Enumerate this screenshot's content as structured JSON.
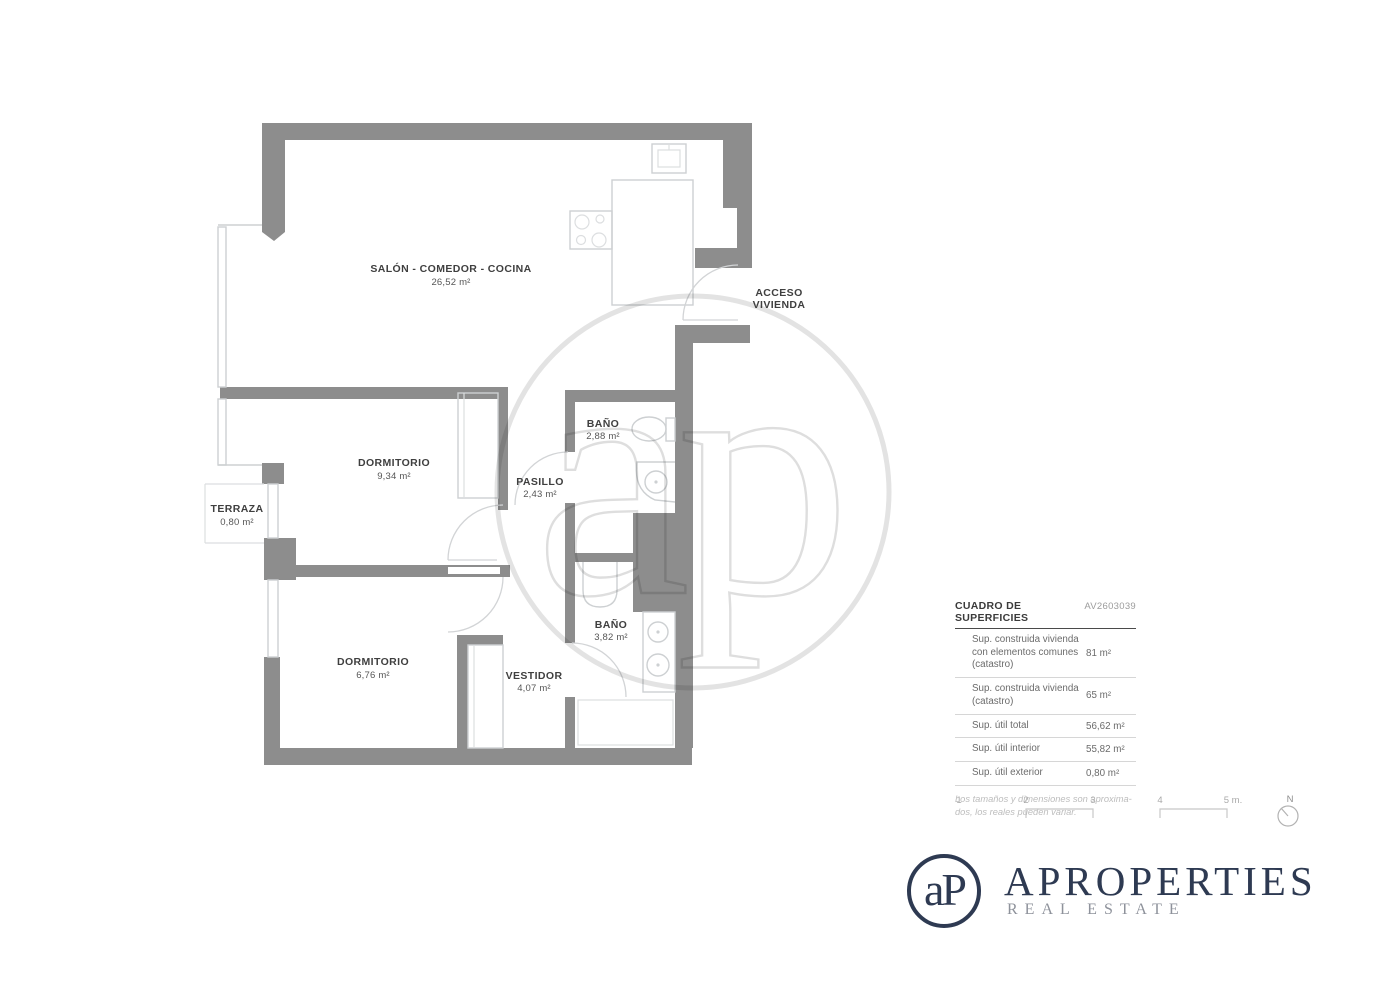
{
  "plan": {
    "rooms": [
      {
        "name": "SALÓN - COMEDOR - COCINA",
        "area": "26,52 m²"
      },
      {
        "name": "DORMITORIO",
        "area": "9,34 m²"
      },
      {
        "name": "PASILLO",
        "area": "2,43 m²"
      },
      {
        "name": "BAÑO",
        "area": "2,88 m²"
      },
      {
        "name": "TERRAZA",
        "area": "0,80 m²"
      },
      {
        "name": "DORMITORIO",
        "area": "6,76 m²"
      },
      {
        "name": "VESTIDOR",
        "area": "4,07 m²"
      },
      {
        "name": "BAÑO",
        "area": "3,82 m²"
      }
    ],
    "entrance": {
      "line1": "ACCESO",
      "line2": "VIVIENDA"
    }
  },
  "surface_table": {
    "title": "CUADRO DE SUPERFICIES",
    "reference": "AV2603039",
    "rows": [
      {
        "label": "Sup. construida vivienda con elementos comunes (catastro)",
        "value": "81 m²"
      },
      {
        "label": "Sup. construida vivienda (catastro)",
        "value": "65 m²"
      },
      {
        "label": "Sup. útil total",
        "value": "56,62 m²"
      },
      {
        "label": "Sup. útil interior",
        "value": "55,82 m²"
      },
      {
        "label": "Sup. útil exterior",
        "value": "0,80 m²"
      }
    ],
    "note": "Los tamaños y dimensiones son aproxima-\ndos, los reales pueden variar."
  },
  "scale_bar": {
    "labels": [
      "1",
      "2",
      "3",
      "4",
      "5 m."
    ]
  },
  "north": {
    "label": "N"
  },
  "watermark": {
    "monogram": "ap"
  },
  "logo": {
    "monogram": "aP",
    "brand": "APROPERTIES",
    "tagline": "REAL ESTATE"
  },
  "colors": {
    "wall": "#8d8d8d",
    "fixture_line": "#cdd0d2",
    "brand_navy": "#2e3a52",
    "text_dark": "#3f3f3f",
    "table_text": "#6b6b6b",
    "note_gray": "#bdbdbd"
  }
}
